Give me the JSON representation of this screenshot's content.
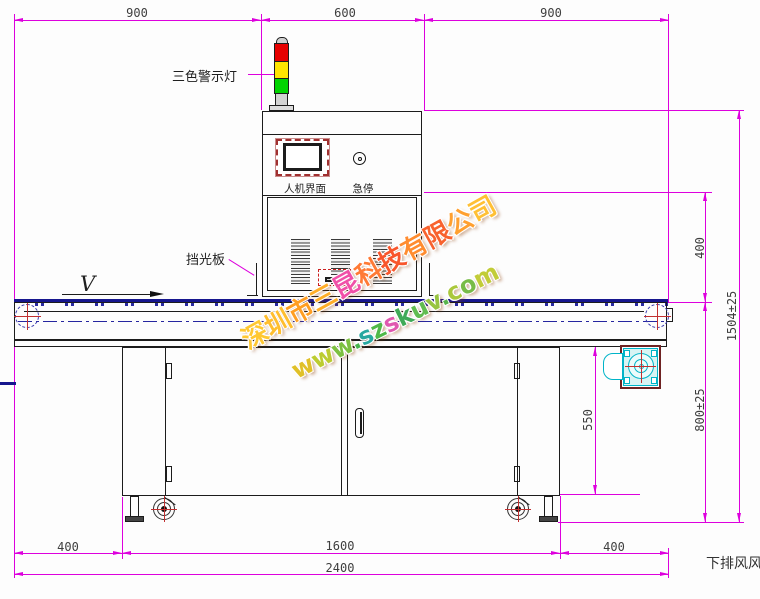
{
  "drawing": {
    "title_hint": "UV curing conveyor machine front-view dimensional drawing",
    "dims_top": [
      "900",
      "600",
      "900"
    ],
    "dims_right": {
      "d400": "400",
      "d1504": "1504±25",
      "d800": "800±25",
      "d550": "550"
    },
    "dims_bottom_row1": [
      "400",
      "1600",
      "400"
    ],
    "dims_bottom_row2": "2400",
    "labels": {
      "tower_light": "三色警示灯",
      "hmi": "人机界面",
      "estop": "急停",
      "light_shield": "挡光板",
      "bottom_exhaust": "下排风风",
      "belt_direction": "V"
    },
    "watermark": {
      "line1": "深圳市三昆科技有限公司",
      "line2": "www.szskuv.com",
      "colors1": [
        "#ffc832",
        "#ffbe2e",
        "#ff9e22",
        "#ffae28",
        "#f050a8",
        "#ff7a35",
        "#f8562c",
        "#ff8c30",
        "#f8622e",
        "#ffa030",
        "#ffc035"
      ],
      "colors2": [
        "#e0c028",
        "#bccc30",
        "#7cc040",
        "#48b44c",
        "#28a8a0",
        "#50b848",
        "#e058b0",
        "#40aa58",
        "#60bc50",
        "#98c542",
        "#58b44c",
        "#aac83c",
        "#78bc48",
        "#c2cc38"
      ]
    },
    "colors": {
      "dimension_magenta": "#dd00dd",
      "conveyor_navy": "#16168e",
      "crosshair_red": "#c23030",
      "fan_cyan": "#00b4c8",
      "tower_red": "#e60000",
      "tower_yellow": "#ffe400",
      "tower_green": "#00d400"
    }
  }
}
